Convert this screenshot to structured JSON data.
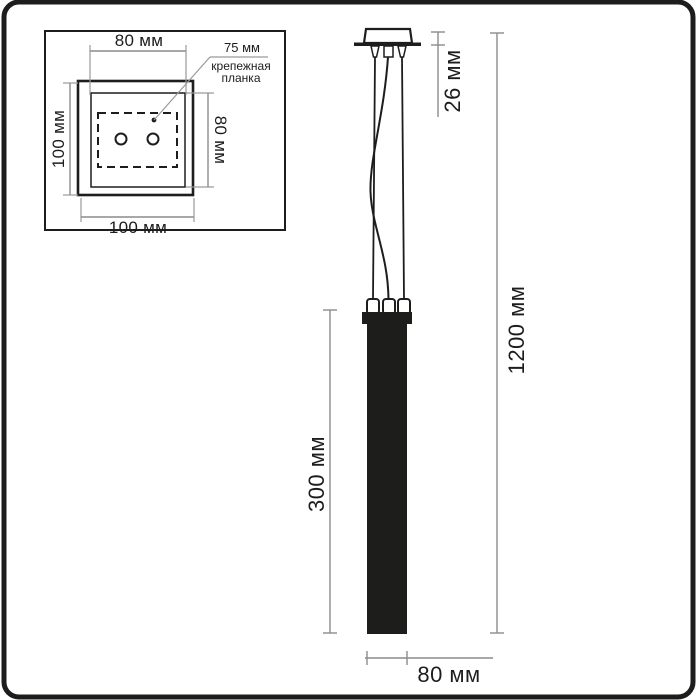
{
  "figure_title": "pendant-lamp-dimension-diagram",
  "colors": {
    "ink": "#1d1d1b",
    "dimension_line": "#8c8c8c",
    "background": "#ffffff"
  },
  "inset_top_view": {
    "inner_width_label": "80 мм",
    "outer_height_label": "100 мм",
    "inner_height_label": "80 мм",
    "outer_width_label": "100 мм",
    "callout": {
      "value": "75 мм",
      "label_line1": "крепежная",
      "label_line2": "планка"
    }
  },
  "side_view": {
    "canopy_height_label": "26 мм",
    "overall_height_label": "1200 мм",
    "shade_height_label": "300 мм",
    "shade_width_label": "80 мм"
  }
}
